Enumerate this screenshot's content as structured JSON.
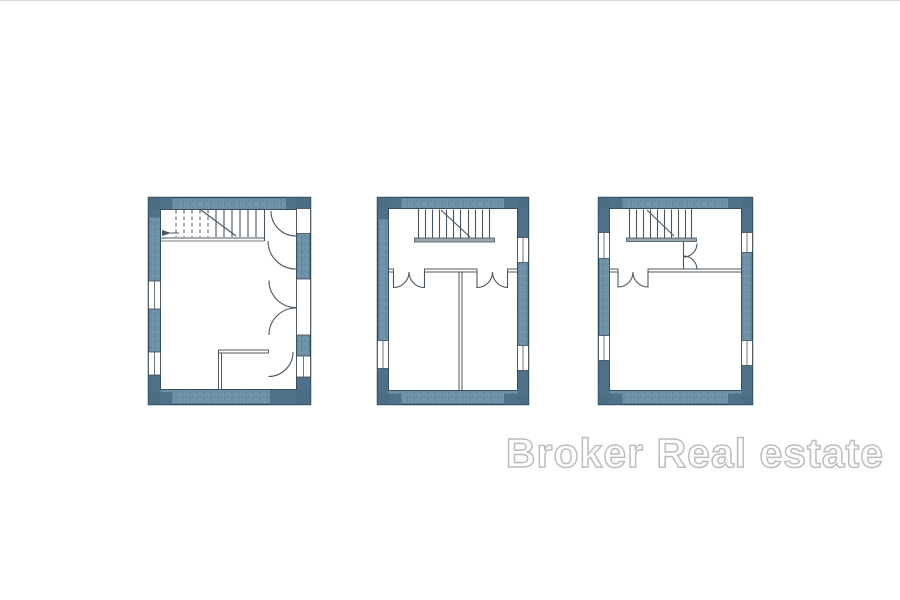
{
  "watermark": {
    "text": "Broker Real estate",
    "fill": "#ffffff",
    "outline": "#bdbdbd"
  },
  "palette": {
    "wall": "#6f93a9",
    "wall_dark": "#4b6c84",
    "wall_outline": "#2e4b5e",
    "line": "#4a5560",
    "stair_landing_bar": "#97a6ae",
    "background": "#ffffff"
  },
  "plans": [
    {
      "id": "left",
      "features": "staircase, five door swings, small corner room, four windows"
    },
    {
      "id": "middle",
      "features": "staircase, hallway, two rooms, two double-swing doors, three windows"
    },
    {
      "id": "right",
      "features": "staircase, double-swing doors, one large room, four windows"
    }
  ]
}
